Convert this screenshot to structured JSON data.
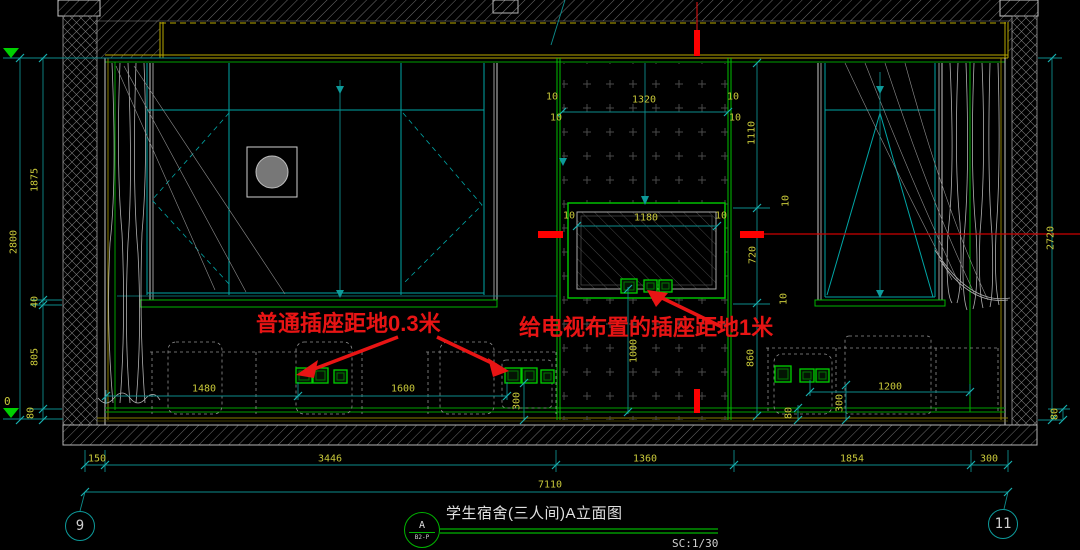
{
  "drawing": {
    "type": "interior-elevation",
    "room": "student-dormitory-3person"
  },
  "notes": {
    "left": "普通插座距地0.3米",
    "right": "给电视布置的插座距地1米"
  },
  "title_block": {
    "detail_letter": "A",
    "detail_ref": "B2-P",
    "title": "学生宿舍(三人间)A立面图",
    "scale": "SC:1/30"
  },
  "grid_bubbles": {
    "left": "9",
    "right": "11"
  },
  "elevation": {
    "bottom_level": "0"
  },
  "colors": {
    "background": "#000000",
    "dim_text": "#c9c93a",
    "dim_line": "#0d8c8c",
    "frame_cyan": "#00a6a6",
    "green": "#00c000",
    "yellow_line": "#b9a800",
    "red": "#e81414",
    "gray_line": "#c9c9c9"
  },
  "dim_labels": [
    {
      "t": "2800",
      "x": 14,
      "y": 242,
      "r": 1
    },
    {
      "t": "1875",
      "x": 35,
      "y": 180,
      "r": 1
    },
    {
      "t": "40",
      "x": 35,
      "y": 302,
      "r": 1
    },
    {
      "t": "805",
      "x": 35,
      "y": 357,
      "r": 1
    },
    {
      "t": "80",
      "x": 31,
      "y": 413,
      "r": 1
    },
    {
      "t": "2720",
      "x": 1051,
      "y": 238,
      "r": 1
    },
    {
      "t": "80",
      "x": 1055,
      "y": 414,
      "r": 1
    },
    {
      "t": "80",
      "x": 789,
      "y": 413,
      "r": 1
    },
    {
      "t": "1320",
      "x": 644,
      "y": 100,
      "r": 0
    },
    {
      "t": "10",
      "x": 552,
      "y": 97,
      "r": 0
    },
    {
      "t": "10",
      "x": 556,
      "y": 118,
      "r": 0
    },
    {
      "t": "10",
      "x": 733,
      "y": 97,
      "r": 0
    },
    {
      "t": "10",
      "x": 735,
      "y": 118,
      "r": 0
    },
    {
      "t": "1110",
      "x": 752,
      "y": 133,
      "r": 1
    },
    {
      "t": "10",
      "x": 786,
      "y": 201,
      "r": 1
    },
    {
      "t": "720",
      "x": 753,
      "y": 255,
      "r": 1
    },
    {
      "t": "10",
      "x": 784,
      "y": 299,
      "r": 1
    },
    {
      "t": "860",
      "x": 751,
      "y": 358,
      "r": 1
    },
    {
      "t": "1180",
      "x": 646,
      "y": 218,
      "r": 0
    },
    {
      "t": "10",
      "x": 569,
      "y": 216,
      "r": 0
    },
    {
      "t": "10",
      "x": 721,
      "y": 216,
      "r": 0
    },
    {
      "t": "1000",
      "x": 634,
      "y": 351,
      "r": 1
    },
    {
      "t": "1480",
      "x": 204,
      "y": 389,
      "r": 0
    },
    {
      "t": "1600",
      "x": 403,
      "y": 389,
      "r": 0
    },
    {
      "t": "300",
      "x": 517,
      "y": 401,
      "r": 1
    },
    {
      "t": "300",
      "x": 840,
      "y": 403,
      "r": 1
    },
    {
      "t": "1200",
      "x": 890,
      "y": 387,
      "r": 0
    },
    {
      "t": "150",
      "x": 97,
      "y": 459,
      "r": 0
    },
    {
      "t": "3446",
      "x": 330,
      "y": 459,
      "r": 0
    },
    {
      "t": "1360",
      "x": 645,
      "y": 459,
      "r": 0
    },
    {
      "t": "1854",
      "x": 852,
      "y": 459,
      "r": 0
    },
    {
      "t": "300",
      "x": 989,
      "y": 459,
      "r": 0
    },
    {
      "t": "7110",
      "x": 550,
      "y": 485,
      "r": 0
    }
  ]
}
